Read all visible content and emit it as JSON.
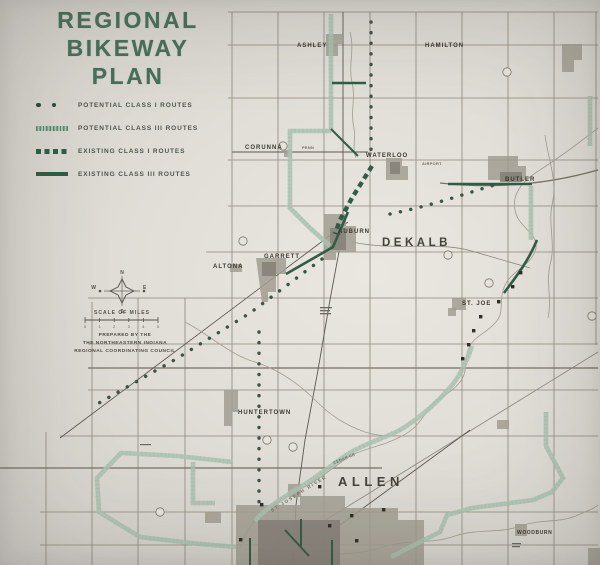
{
  "title": {
    "lines": [
      "REGIONAL",
      "BIKEWAY",
      "PLAN"
    ]
  },
  "legend": {
    "items": [
      {
        "id": "potential-class-1",
        "label": "POTENTIAL CLASS I ROUTES",
        "style": "dots"
      },
      {
        "id": "potential-class-3",
        "label": "POTENTIAL CLASS III ROUTES",
        "style": "hatched"
      },
      {
        "id": "existing-class-1",
        "label": "EXISTING CLASS I ROUTES",
        "style": "dashed-squares"
      },
      {
        "id": "existing-class-3",
        "label": "EXISTING CLASS III ROUTES",
        "style": "solid"
      }
    ]
  },
  "compass": {
    "north": "N",
    "south": "S",
    "east": "E",
    "west": "W"
  },
  "scale": {
    "label": "SCALE OF MILES",
    "ticks": [
      "0",
      "1",
      "2",
      "3",
      "4",
      "5"
    ]
  },
  "credit": {
    "lines": [
      "PREPARED BY THE",
      "THE NORTHEASTERN INDIANA",
      "REGIONAL COORDINATING COUNCIL"
    ]
  },
  "map": {
    "counties": [
      {
        "name": "DEKALB"
      },
      {
        "name": "ALLEN"
      }
    ],
    "towns": [
      {
        "name": "ASHLEY"
      },
      {
        "name": "HAMILTON"
      },
      {
        "name": "CORUNNA"
      },
      {
        "name": "WATERLOO"
      },
      {
        "name": "BUTLER"
      },
      {
        "name": "AUBURN"
      },
      {
        "name": "GARRETT"
      },
      {
        "name": "ALTONA"
      },
      {
        "name": "ST. JOE"
      },
      {
        "name": "HUNTERTOWN"
      },
      {
        "name": "WOODBURN"
      }
    ],
    "labels": {
      "airport": "AIRPORT",
      "railroad": "PENN",
      "river": "ST JOSEPH RIVER",
      "creek": "CEDAR CR"
    }
  },
  "colors": {
    "title_green": "#47705a",
    "route_existing": "#2f5d45",
    "route_potential_class3": "#57876b",
    "route_potential_class1": "#3a5547",
    "paper": "#e1ded8"
  }
}
